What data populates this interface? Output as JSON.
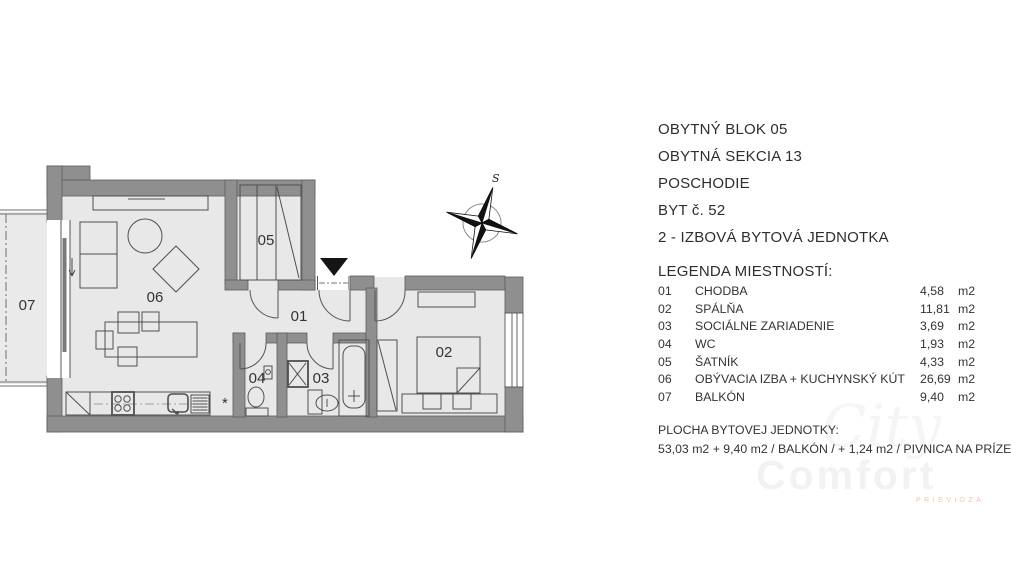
{
  "header": {
    "lines": [
      "OBYTNÝ BLOK 05",
      "OBYTNÁ SEKCIA 13",
      "POSCHODIE",
      "BYT č. 52",
      "2 - IZBOVÁ BYTOVÁ JEDNOTKA"
    ]
  },
  "legend": {
    "title": "LEGENDA MIESTNOSTÍ:",
    "rows": [
      {
        "num": "01",
        "name": "CHODBA",
        "area": "4,58",
        "unit": "m2"
      },
      {
        "num": "02",
        "name": "SPÁLŇA",
        "area": "11,81",
        "unit": "m2"
      },
      {
        "num": "03",
        "name": "SOCIÁLNE ZARIADENIE",
        "area": "3,69",
        "unit": "m2"
      },
      {
        "num": "04",
        "name": "WC",
        "area": "1,93",
        "unit": "m2"
      },
      {
        "num": "05",
        "name": "ŠATNÍK",
        "area": "4,33",
        "unit": "m2"
      },
      {
        "num": "06",
        "name": "OBÝVACIA IZBA + KUCHYNSKÝ KÚT",
        "area": "26,69",
        "unit": "m2"
      },
      {
        "num": "07",
        "name": "BALKÓN",
        "area": "9,40",
        "unit": "m2"
      }
    ]
  },
  "footer": {
    "title": "PLOCHA BYTOVEJ JEDNOTKY:",
    "line": "53,03 m2 + 9,40 m2 / BALKÓN / + 1,24 m2 / PIVNICA NA PRÍZEMÍ"
  },
  "watermark": {
    "script": "City",
    "name": "Comfort",
    "sub": "PRIEVIDZA"
  },
  "plan": {
    "compass_label": "S",
    "kitchen_marker": "*",
    "room_labels": {
      "r01": "01",
      "r02": "02",
      "r03": "03",
      "r04": "04",
      "r05": "05",
      "r06": "06",
      "r07": "07"
    }
  },
  "colors": {
    "wall": "#8f8f8f",
    "floor": "#e8e8e8",
    "text": "#2e2e2e"
  }
}
